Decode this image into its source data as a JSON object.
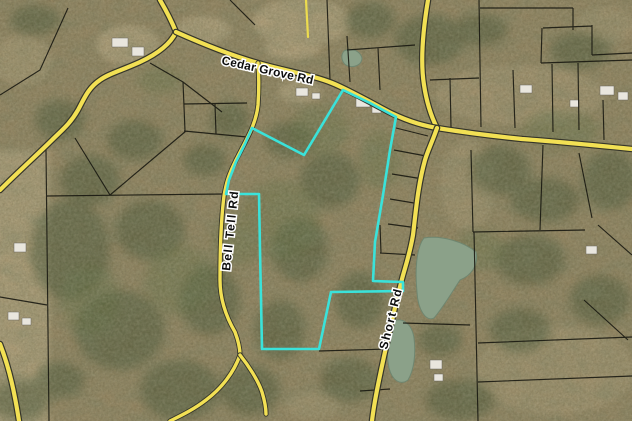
{
  "colors": {
    "map-bg": "#9a8862",
    "road-fill": "#f2e054",
    "road-casing": "#35352a",
    "minor-road": "#eddc4e",
    "parcel-line": "#16160f",
    "selection": "#3ae2da",
    "water": "#8ba189",
    "label-fill": "#0d0d0d",
    "label-halo": "#ffffff",
    "field": "#c6b189",
    "trees": "#41502e",
    "house-fill": "#e9e6de",
    "house-stroke": "#68645c"
  },
  "map": {
    "description": "Aerial parcel map with highlighted property outline",
    "roads": [
      {
        "id": "cedar-grove-rd",
        "name": "Cedar Grove Rd",
        "path": "M176,32 C205,45 230,55 258,63 C290,72 312,75 332,83 C347,89 368,101 391,113 C412,123 426,126 437,128 C462,132 492,136 522,139 C562,142 602,146 632,149"
      },
      {
        "id": "bell-tell-rd",
        "name": "Bell Tell Rd",
        "path": "M258,63 C259,75 259,90 258,105 C256,125 246,140 236,160 C228,176 226,184 224,196 C221,220 220,248 220,280 C220,302 228,320 235,332 C238,340 240,348 240,355"
      },
      {
        "id": "short-rd",
        "name": "Short Rd",
        "path": "M437,128 C433,140 428,150 425,160 C418,185 416,210 413,235 C409,258 404,270 401,283 C396,303 393,315 390,330 C386,347 382,365 378,385 C375,400 373,412 372,421"
      },
      {
        "id": "north-rd",
        "name": "",
        "path": "M428,0 C423,30 420,60 424,85 C427,105 432,118 437,128"
      },
      {
        "id": "west-rd",
        "name": "",
        "path": "M160,0 C167,12 172,22 176,32 C170,45 155,55 140,62 C120,71 108,74 100,80 C88,88 84,99 78,110 C70,124 62,130 52,140 C40,152 18,172 0,190"
      },
      {
        "id": "bell-tell-sw-branch",
        "name": "",
        "path": "M240,355 C234,372 222,388 206,400 C193,410 180,416 170,421"
      },
      {
        "id": "bell-tell-se-branch",
        "name": "",
        "path": "M240,355 C248,365 258,380 262,392 C265,402 266,408 266,414"
      },
      {
        "id": "southwest-rd",
        "name": "",
        "path": "M0,344 C7,362 12,382 15,398 C17,408 18,415 19,421"
      },
      {
        "id": "driveway",
        "name": "",
        "path": "M306,0 L308,37"
      }
    ],
    "labels": [
      {
        "id": "cedar-grove-rd-label",
        "text": "Cedar Grove Rd"
      },
      {
        "id": "bell-tell-rd-label",
        "text": "Bell Tell Rd"
      },
      {
        "id": "short-rd-label",
        "text": "Short Rd"
      }
    ],
    "selected_parcel": {
      "points": "343,90 370,103 396,117 390,150 383,195 375,242 373,281 403,282 403,291 331,292 319,349 262,349 260,250 259,194 226,194 229,180 236,162 245,144 252,128 304,155"
    },
    "parcel_lines": "M46,150 L49,421 M47,196 L224,194 M75,138 L110,195 L186,131 M0,95 L40,70 L68,8 M0,297 L47,305 M319,351 L388,349 M327,0 L330,80 M230,0 L255,25 M150,63 L183,82 L185,131 M183,82 L222,112 M184,104 L247,103 M184,131 L247,137 M215,104 L216,134 M347,36 L350,82 M378,48 L380,90 M347,50 L415,45 M396,128 L428,136 M394,150 L426,156 M392,174 L423,179 M390,199 L420,204 M388,224 L418,228 M380,225 L381,253 M380,253 L415,255 M479,0 L481,127 M480,8 L573,8 M573,8 L573,30 M543,28 L592,26 M542,28 L541,63 M541,63 L632,60 M578,63 L579,130 M552,64 L553,132 M513,70 L515,128 M603,100 L604,140 M592,25 L592,55 M592,55 L632,53 M450,78 L451,127 M430,80 L479,78 M471,150 L473,232 M473,232 L585,230 M543,145 L540,230 M579,153 L592,218 M598,225 L632,255 M474,232 L478,421 M478,343 L632,337 M478,382 L632,376 M584,300 L628,340 M403,323 L470,325 M360,391 L390,389",
    "water": "M424,238 C442,235 464,242 476,252 C479,266 470,276 460,280 C452,292 444,306 434,318 C426,322 418,310 417,292 C415,272 416,248 424,238 Z M392,322 C402,316 412,324 414,338 C416,354 414,370 408,380 C400,386 392,380 389,368 C386,352 386,332 392,322 Z M344,51 C352,47 360,51 362,58 C362,65 354,68 348,66 C342,64 340,56 344,51 Z",
    "buildings": "M112,38 h16 v9 h-16 z M132,47 h12 v9 h-12 z M14,243 h12 v9 h-12 z M8,312 h11 v8 h-11 z M22,318 h9 v7 h-9 z M296,88 h12 v8 h-12 z M312,93 h8 v6 h-8 z M356,98 h14 v9 h-14 z M372,106 h9 v7 h-9 z M600,86 h14 v9 h-14 z M618,92 h10 v8 h-10 z M430,360 h12 v9 h-12 z M434,374 h9 v7 h-9 z M586,246 h11 v8 h-11 z M520,85 h12 v8 h-12 z M570,100 h9 v7 h-9 z"
  }
}
